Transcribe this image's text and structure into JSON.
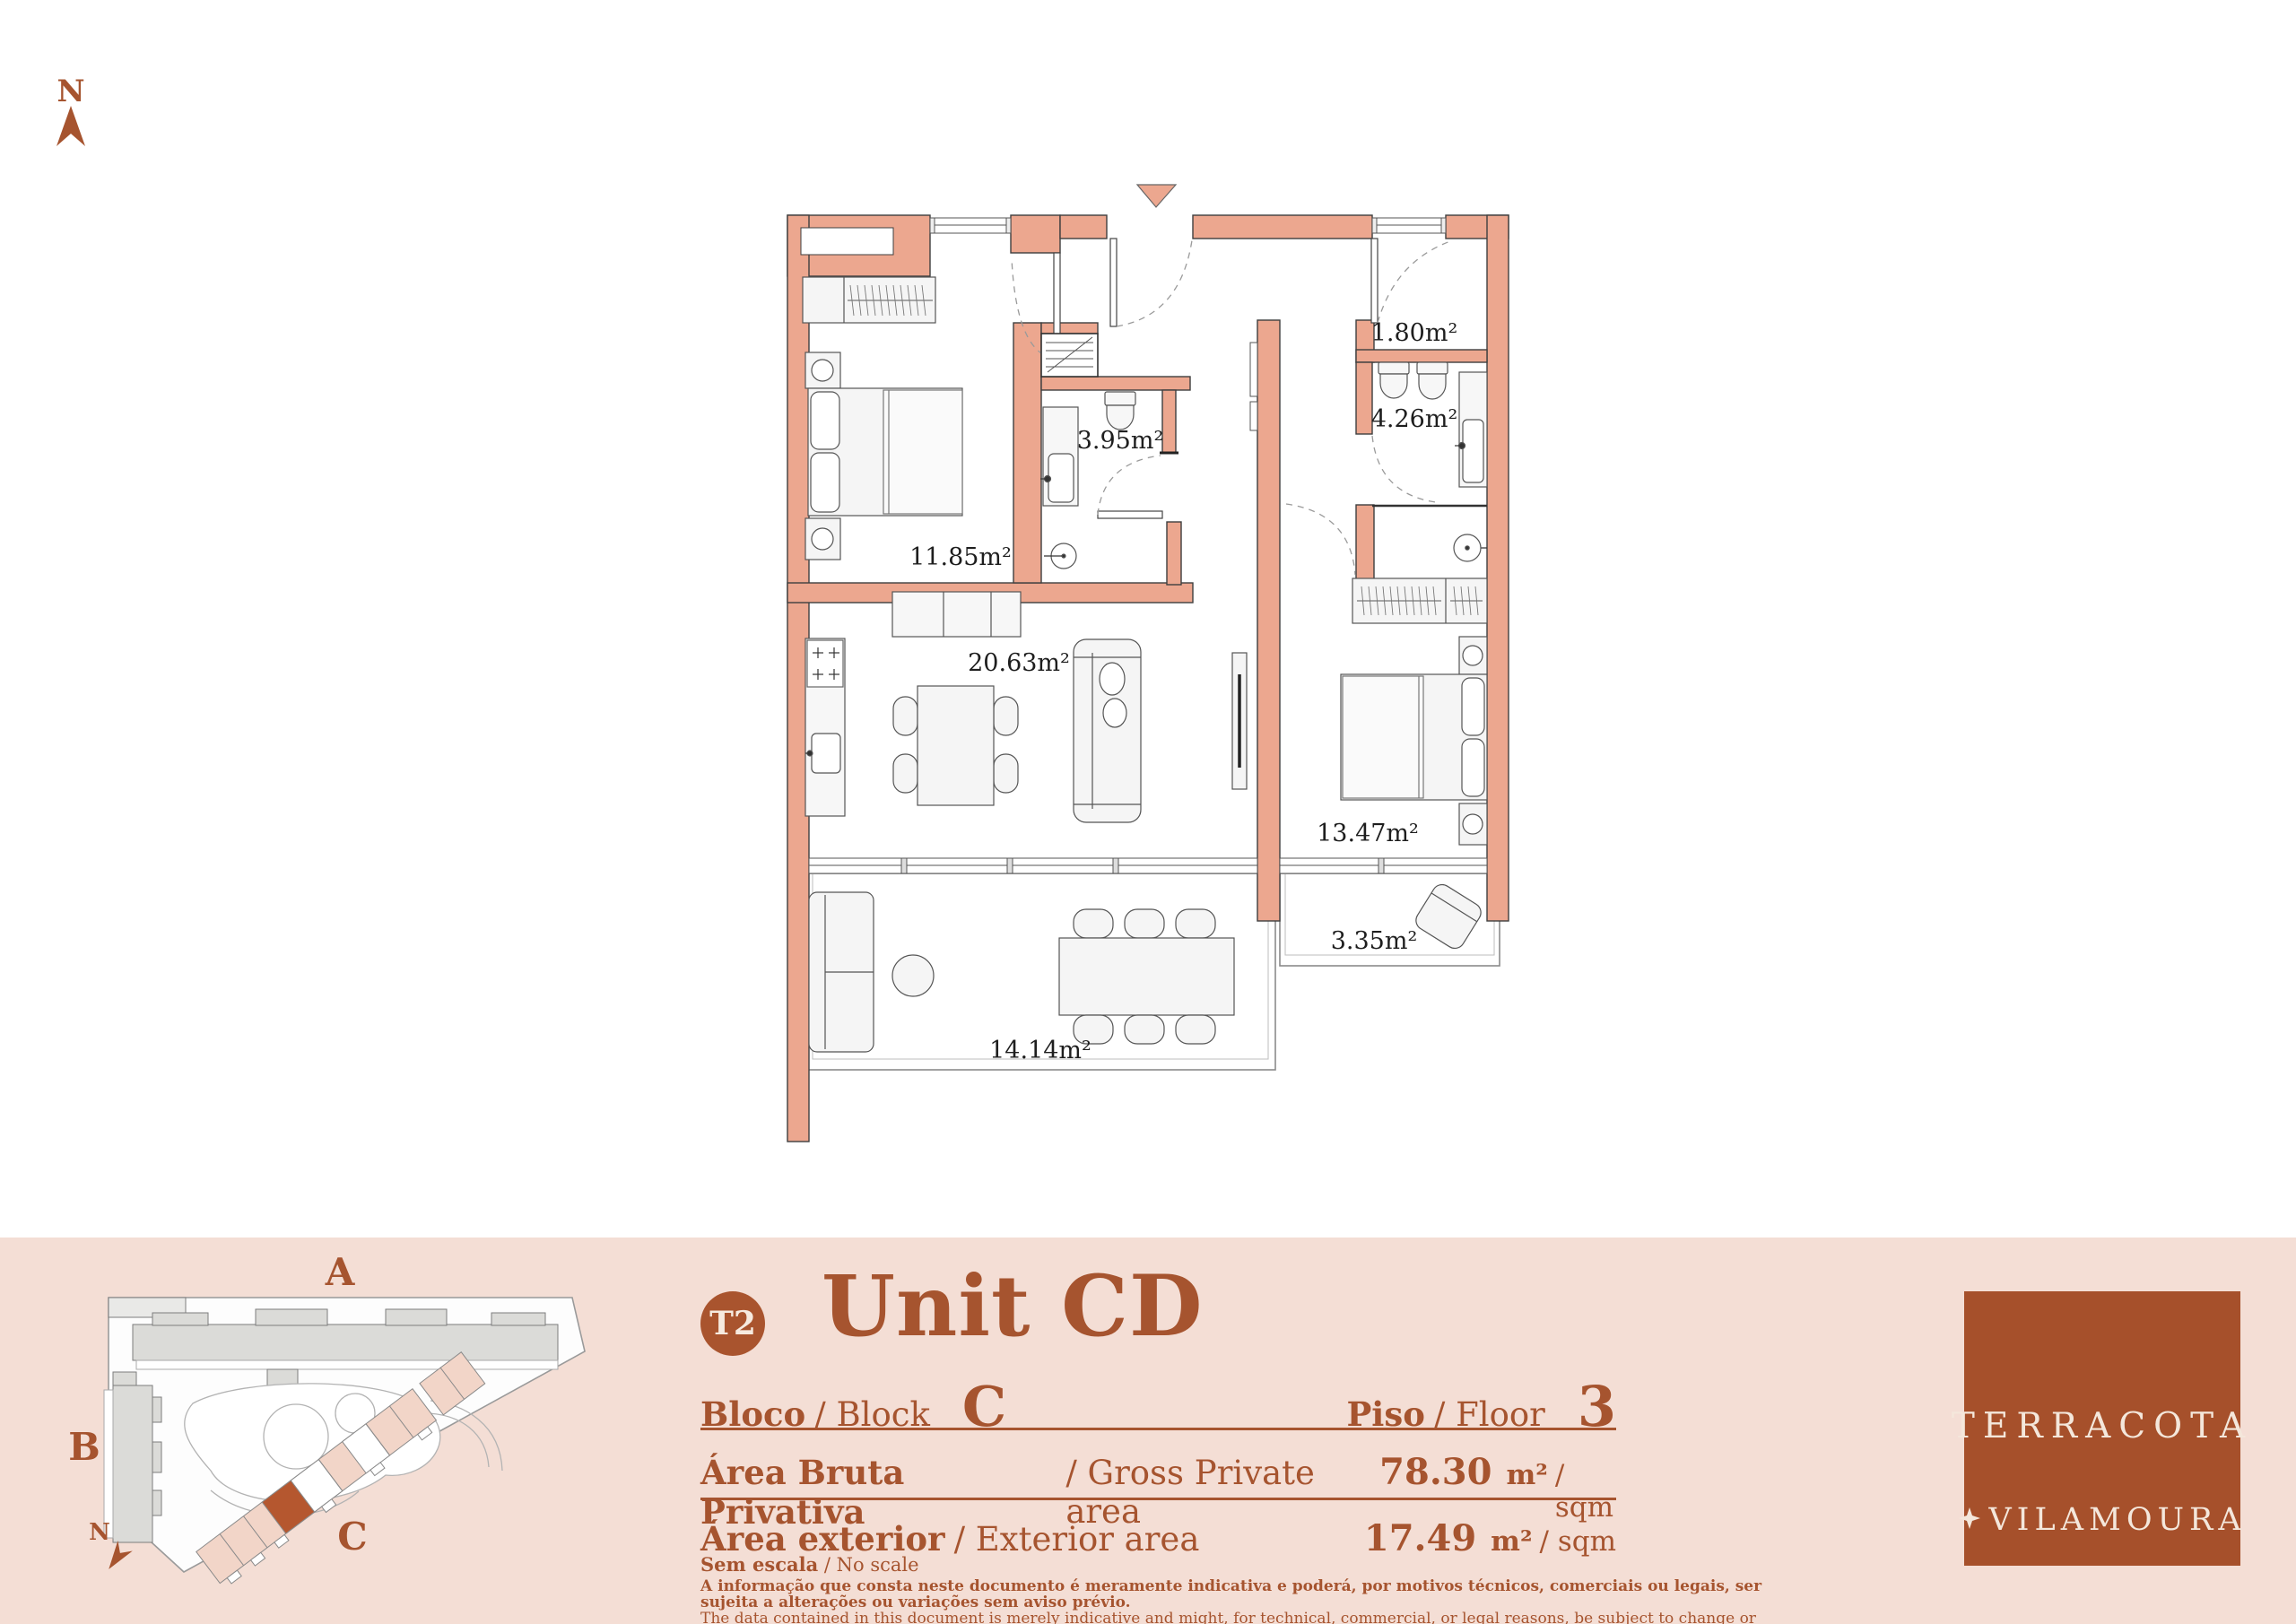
{
  "colors": {
    "wall": "#ECA78F",
    "accent": "#A6542F",
    "logo_bg": "#A6502B",
    "band_bg": "#F4DED5",
    "highlight_unit": "#B5572F",
    "building_gray": "#DBDBD8"
  },
  "north": {
    "label": "N"
  },
  "plan": {
    "rooms": {
      "bedroom1": "11.85m²",
      "bathroom1": "3.95m²",
      "closet": "1.80m²",
      "bathroom2": "4.26m²",
      "living_kitchen": "20.63m²",
      "bedroom2": "13.47m²",
      "balcony": "3.35m²",
      "terrace": "14.14m²"
    }
  },
  "site_plan": {
    "north_label": "N",
    "blocks": [
      {
        "label": "A"
      },
      {
        "label": "B"
      },
      {
        "label": "C"
      }
    ]
  },
  "info": {
    "badge": "T2",
    "title": "Unit CD",
    "block_label_pt": "Bloco",
    "block_label_en": "/ Block",
    "block_value": "C",
    "floor_label_pt": "Piso",
    "floor_label_en": "/ Floor",
    "floor_value": "3",
    "gross_label_pt": "Área Bruta Privativa",
    "gross_label_en": "/ Gross Private area",
    "gross_value": "78.30",
    "gross_unit": "m²",
    "gross_unit_en": "/ sqm",
    "ext_label_pt": "Área exterior",
    "ext_label_en": "/ Exterior area",
    "ext_value": "17.49",
    "ext_unit": "m²",
    "ext_unit_en": "/ sqm",
    "scale_pt": "Sem escala",
    "scale_en": "/ No scale",
    "disclaimer_pt": "A informação que consta neste documento é meramente indicativa e poderá, por motivos técnicos, comerciais ou legais, ser sujeita a alterações ou variações sem aviso prévio.",
    "disclaimer_en": "The data contained in this document is merely indicative and might, for technical, commercial, or legal reasons, be subject to change or variation without prior notice"
  },
  "logo": {
    "line1": "TERRACOTA",
    "line2": "VILAMOURA"
  }
}
